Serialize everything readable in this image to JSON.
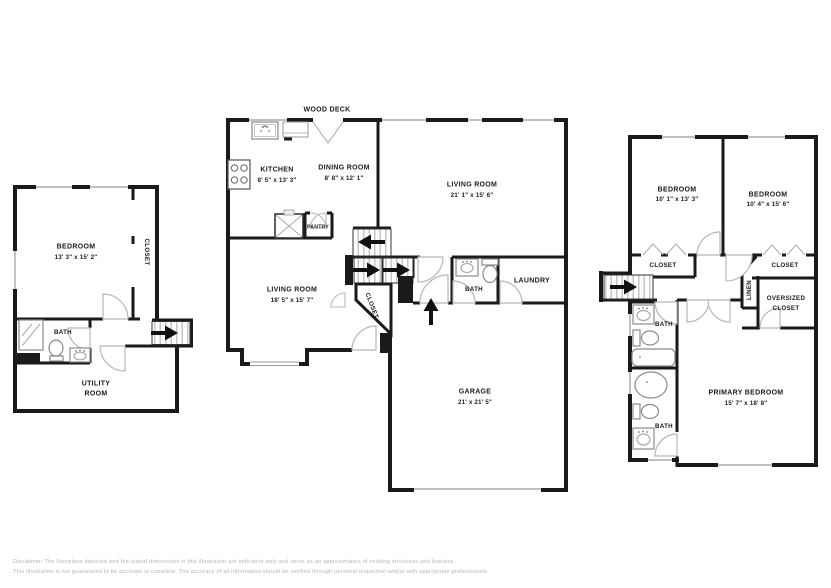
{
  "units": {
    "left": {
      "bedroom_name": "BEDROOM",
      "bedroom_dims": "13' 3\" x 15' 2\"",
      "closet": "CLOSET",
      "bath": "BATH",
      "utility_line1": "UTILITY",
      "utility_line2": "ROOM"
    },
    "main": {
      "wood_deck": "WOOD DECK",
      "kitchen_name": "KITCHEN",
      "kitchen_dims": "8' 5\" x 13' 3\"",
      "dining_name": "DINING ROOM",
      "dining_dims": "8' 8\" x 12' 1\"",
      "pantry": "PANTRY",
      "living_upper_name": "LIVING ROOM",
      "living_upper_dims": "21' 1\" x 15' 6\"",
      "living_lower_name": "LIVING ROOM",
      "living_lower_dims": "18' 5\" x 15' 7\"",
      "closet": "CLOSET",
      "bath": "BATH",
      "laundry": "LAUNDRY",
      "garage_name": "GARAGE",
      "garage_dims": "21' x 21' 5\""
    },
    "upper": {
      "bedroom_left_name": "BEDROOM",
      "bedroom_left_dims": "10' 1\" x 13' 3\"",
      "bedroom_right_name": "BEDROOM",
      "bedroom_right_dims": "10' 4\" x 15' 6\"",
      "closet_left": "CLOSET",
      "closet_right": "CLOSET",
      "linen": "LINEN",
      "oversized_line1": "OVERSIZED",
      "oversized_line2": "CLOSET",
      "bath_upper": "BATH",
      "bath_lower": "BATH",
      "primary_name": "PRIMARY BEDROOM",
      "primary_dims": "15' 7\" x 18' 8\""
    }
  },
  "disclaimer": {
    "line1": "Disclaimer: The floorplans depicted and the stated dimensions in this illustration are indicative only and serve as an approximation of existing structures and features.",
    "line2": "This illustration is not guaranteed to be accurate or complete. The accuracy of all information should be verified through personal inspection and/or with appropriate professionals."
  },
  "colors": {
    "wall": "#1a1a1a",
    "fixture_stroke": "#8a8a8a",
    "stair_tread": "#c6c6c6",
    "door_arc": "#b8b8b8",
    "disclaimer_text": "#b5b5b5"
  }
}
